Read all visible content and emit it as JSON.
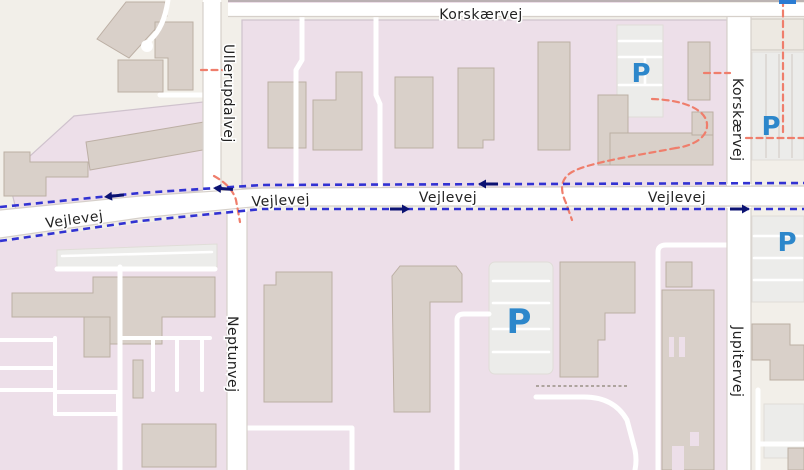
{
  "streets": {
    "korskaervej": "Korskærvej",
    "vejlevej": "Vejlevej",
    "ullerupdalvej": "Ullerupdalvej",
    "neptunvej": "Neptunvej",
    "jupitervej": "Jupitervej"
  },
  "parking": {
    "symbol": "P",
    "visible_count": 4
  },
  "routes": {
    "cycle_route_color": "#3232d2",
    "cycle_arrow_color": "#0b1272",
    "cycle_arrow_directions": [
      "west",
      "west",
      "west",
      "east",
      "east"
    ],
    "foot_route_color": "#ef7e6c"
  },
  "colors": {
    "background": "#f2efe9",
    "commercial_area": "#eddfe9",
    "building_fill": "#d9d0c9",
    "building_stroke": "#bcafa4",
    "road_fill": "#ffffff",
    "road_casing": "#d6d0ca",
    "parking_area": "#ececea",
    "parking_symbol": "#2d87cb",
    "street_label": "#222222",
    "map_marker_blue": "#2b7cd3"
  }
}
